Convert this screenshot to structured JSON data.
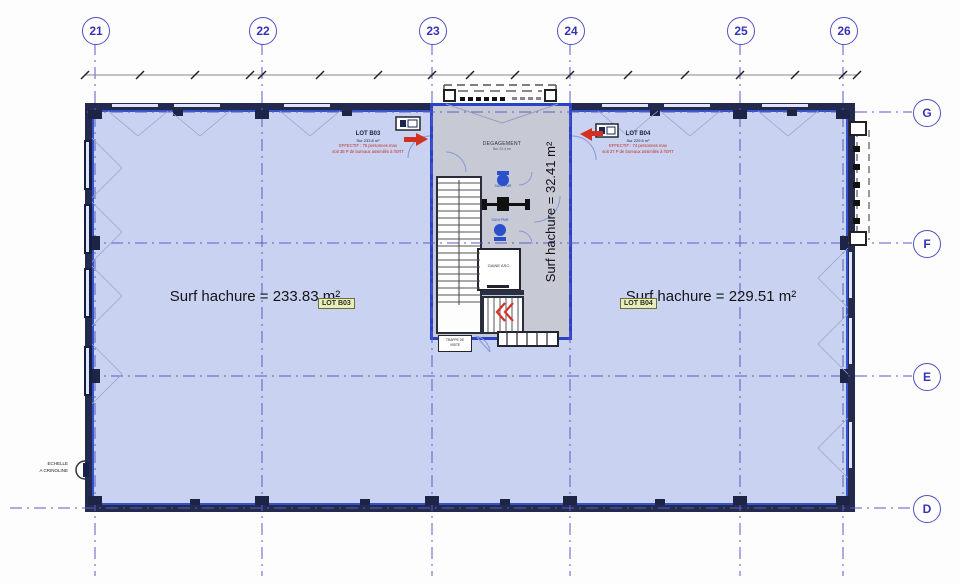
{
  "grid": {
    "columns": [
      {
        "label": "21"
      },
      {
        "label": "22"
      },
      {
        "label": "23"
      },
      {
        "label": "24"
      },
      {
        "label": "25"
      },
      {
        "label": "26"
      }
    ],
    "rows": [
      {
        "label": "G"
      },
      {
        "label": "F"
      },
      {
        "label": "E"
      },
      {
        "label": "D"
      }
    ]
  },
  "zones": {
    "left": {
      "surface": "Surf hachure = 233.83 m²",
      "tag": "LOT B03"
    },
    "right": {
      "surface": "Surf hachure = 229.51 m²",
      "tag": "LOT B04"
    },
    "core": {
      "surface": "Surf hachure = 32.41 m²"
    }
  },
  "headers": {
    "b03": {
      "name": "LOT B03",
      "area": "Sur 233.8 m²",
      "eff1": "EFFECTIF : 75 personnes max",
      "eff2": "soit 38 P de bureaux assimilés à l'ERT"
    },
    "b04": {
      "name": "LOT B04",
      "area": "Sur 229.5 m²",
      "eff1": "EFFECTIF : 74 personnes max",
      "eff2": "soit 37 P de bureaux assimilés à l'ERT"
    }
  },
  "core": {
    "degagement": "DEGAGEMENT",
    "degagement_area": "Sur 22.4 m²",
    "gaine": "GAINE ASC.",
    "sani": "SANI PMR",
    "trappe1": "TRAPPE DE",
    "trappe2": "VISITE"
  },
  "misc": {
    "echelle1": "ECHELLE",
    "echelle2": "A CRINOLINE"
  },
  "colors": {
    "grid_blue": "#5c5cc8",
    "zone_fill": "#c9d2f1",
    "wall_dark": "#232a4d",
    "core_fill": "#c7c9d4",
    "core_wall": "#2843c8",
    "safety_red": "#d43020",
    "lot_tag_bg": "#e9edbb"
  }
}
